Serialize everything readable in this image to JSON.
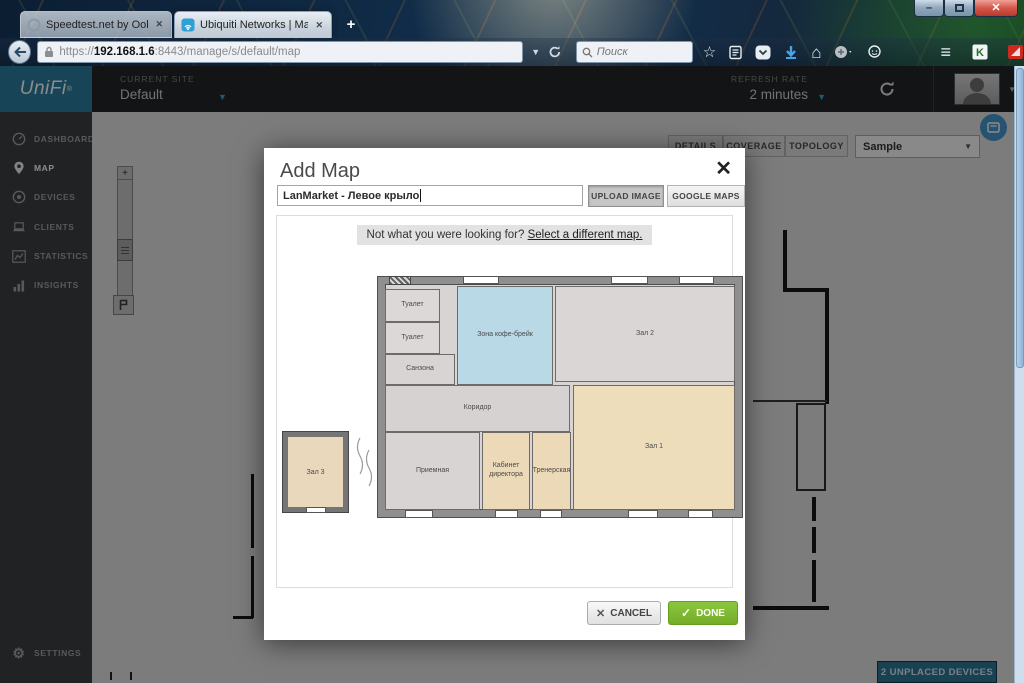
{
  "icons": {
    "minimize": "–",
    "close_window": "✕",
    "new_tab": "+",
    "tab_close": "✕",
    "dropdown": "▼",
    "hamburger": "≡",
    "star": "☆",
    "home": "⌂",
    "gear": "⚙",
    "check": "✓",
    "cross": "✕",
    "plus": "+",
    "minus": "−",
    "k_badge": "K"
  },
  "browser": {
    "tabs": [
      {
        "title": "Speedtest.net by Ookla - Г..."
      },
      {
        "title": "Ubiquiti Networks | Map"
      }
    ],
    "url_scheme": "https://",
    "url_host": "192.168.1.6",
    "url_rest": ":8443/manage/s/default/map",
    "search_placeholder": "Поиск"
  },
  "unifi": {
    "brand": "UniFi",
    "current_site_label": "CURRENT SITE",
    "current_site_value": "Default",
    "refresh_rate_label": "REFRESH RATE",
    "refresh_rate_value": "2 minutes",
    "sidebar": [
      {
        "label": "DASHBOARD"
      },
      {
        "label": "MAP"
      },
      {
        "label": "DEVICES"
      },
      {
        "label": "CLIENTS"
      },
      {
        "label": "STATISTICS"
      },
      {
        "label": "INSIGHTS"
      }
    ],
    "settings_label": "SETTINGS",
    "map_tabs": [
      {
        "label": "DETAILS"
      },
      {
        "label": "COVERAGE"
      },
      {
        "label": "TOPOLOGY"
      }
    ],
    "map_select_value": "Sample",
    "unplaced_devices_label": "2 UNPLACED DEVICES"
  },
  "modal": {
    "title": "Add Map",
    "name_value": "LanMarket - Левое крыло",
    "upload_image_label": "UPLOAD IMAGE",
    "google_maps_label": "GOOGLE MAPS",
    "notice_text": "Not what you were looking for? ",
    "notice_link": "Select a different map.",
    "cancel_label": "CANCEL",
    "done_label": "DONE"
  },
  "floorplan": {
    "rooms": [
      {
        "label": "Туалет"
      },
      {
        "label": "Туалет"
      },
      {
        "label": "Санзона"
      },
      {
        "label": "Зона кофе-брейк"
      },
      {
        "label": "Зал 2"
      },
      {
        "label": "Коридор"
      },
      {
        "label": "Приемная"
      },
      {
        "label": "Кабинет директора"
      },
      {
        "label": "Тренерская"
      },
      {
        "label": "Зал 1"
      },
      {
        "label": "Зал 3"
      }
    ]
  },
  "colors": {
    "accent_teal": "#35a7cc",
    "done_green": "#7cb82f",
    "unifi_logo_bg": "#2a7e9e",
    "coffee_room_blue": "#b9d9e6",
    "hall_tan": "#eeddbb"
  }
}
